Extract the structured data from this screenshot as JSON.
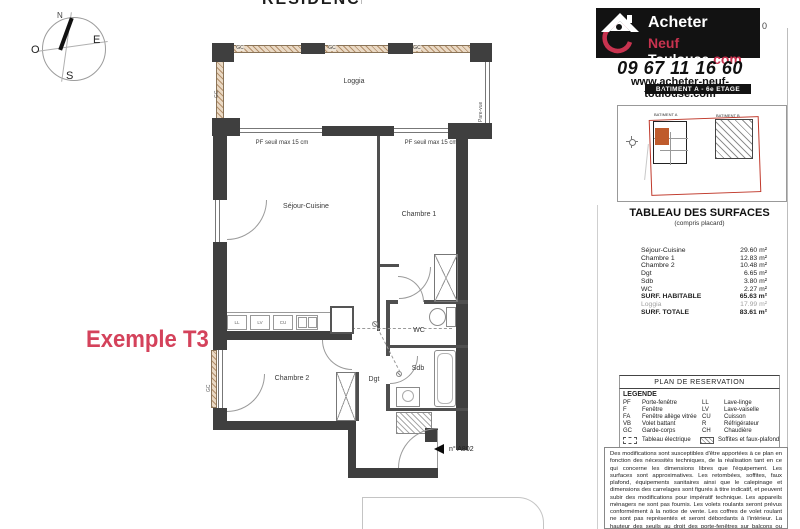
{
  "colors": {
    "wall": "#3f3f3f",
    "accent_red": "#d4425b",
    "logo_red": "#c8334f",
    "logo_black": "#121212",
    "site_unit_orange": "#bf5b2c",
    "boundary_red": "#c0392b",
    "railing_beige": "#ead9c4"
  },
  "compass": {
    "north": "N",
    "east": "E",
    "south": "S",
    "west": "O"
  },
  "plan": {
    "partial_title": "RESIDENCE",
    "example_label": "Exemple T3",
    "unit_number": "n° A802",
    "rooms": {
      "loggia": "Loggia",
      "sejour": "Séjour-Cuisine",
      "chambre1": "Chambre 1",
      "chambre2": "Chambre 2",
      "wc": "WC",
      "sdb": "Sdb",
      "dgt": "Dgt"
    },
    "annotations": {
      "gc": "GC",
      "pare_vue": "Pare-vue",
      "pf_seuil": "PF seuil max 15 cm"
    },
    "kitchen_labels": {
      "ll": "LL",
      "lv": "LV",
      "cu": "CU"
    }
  },
  "header": {
    "logo": {
      "line1": "Acheter",
      "line2_red": "Neuf ",
      "line2_white": "Toulouse",
      "line2_suffix": ".com"
    },
    "stray": "0",
    "phone": "09 67 11 16 60",
    "website": "www.acheter-neuf-toulouse.com",
    "building_bar": "BATIMENT A - 6e ETAGE"
  },
  "siteplan": {
    "batiment_a": "BATIMENT A",
    "batiment_b": "BATIMENT B"
  },
  "surfaces": {
    "title": "TABLEAU DES SURFACES",
    "subtitle": "(compris placard)",
    "rows": [
      {
        "label": "Séjour-Cuisine",
        "value": "29.60 m²"
      },
      {
        "label": "Chambre 1",
        "value": "12.83 m²"
      },
      {
        "label": "Chambre 2",
        "value": "10.48 m²"
      },
      {
        "label": "Dgt",
        "value": "6.65 m²"
      },
      {
        "label": "Sdb",
        "value": "3.80 m²"
      },
      {
        "label": "WC",
        "value": "2.27 m²"
      }
    ],
    "habitable": {
      "label": "SURF. HABITABLE",
      "value": "65.63 m²"
    },
    "loggia": {
      "label": "Loggia",
      "value": "17.99 m²"
    },
    "totale": {
      "label": "SURF. TOTALE",
      "value": "83.61 m²"
    }
  },
  "reservation_title": "PLAN DE RESERVATION",
  "legend": {
    "title": "LEGENDE",
    "left": [
      {
        "abbr": "PF",
        "label": "Porte-fenêtre"
      },
      {
        "abbr": "F",
        "label": "Fenêtre"
      },
      {
        "abbr": "FA",
        "label": "Fenêtre allège vitrée"
      },
      {
        "abbr": "VB",
        "label": "Volet battant"
      },
      {
        "abbr": "GC",
        "label": "Garde-corps"
      }
    ],
    "right": [
      {
        "abbr": "LL",
        "label": "Lave-linge"
      },
      {
        "abbr": "LV",
        "label": "Lave-vaiselle"
      },
      {
        "abbr": "CU",
        "label": "Cuisson"
      },
      {
        "abbr": "R",
        "label": "Réfrigérateur"
      },
      {
        "abbr": "CH",
        "label": "Chaudière"
      }
    ],
    "electrical": "Tableau électrique",
    "soffits": "Soffites et faux-plafond"
  },
  "disclaimer": "Des modifications sont susceptibles d'être apportées à ce plan en fonction des nécessités techniques, de la réalisation tant en ce qui concerne les dimensions libres que l'équipement. Les surfaces sont approximatives. Les retombées, soffites, faux plafond, équipements sanitaires ainsi que le calepinage et dimensions des carrelages sont figurés à titre indicatif, et peuvent subir des modifications pour impératif technique. Les appareils ménagers ne sont pas fournis. Les volets roulants seront prévus conformément à la notice de vente. Les coffres de volet roulant ne sont pas représentés et seront débordants à l'intérieur. La hauteur des seuils au droit des porte-fenêtres sur balcons ou terrasses pourra varier de 5 à 35 cm à partir du sol intérieur. La hauteur entre le jardin et la terrasse pourra varier entre 0 et 60 cm. Les jardins ne seront pas"
}
